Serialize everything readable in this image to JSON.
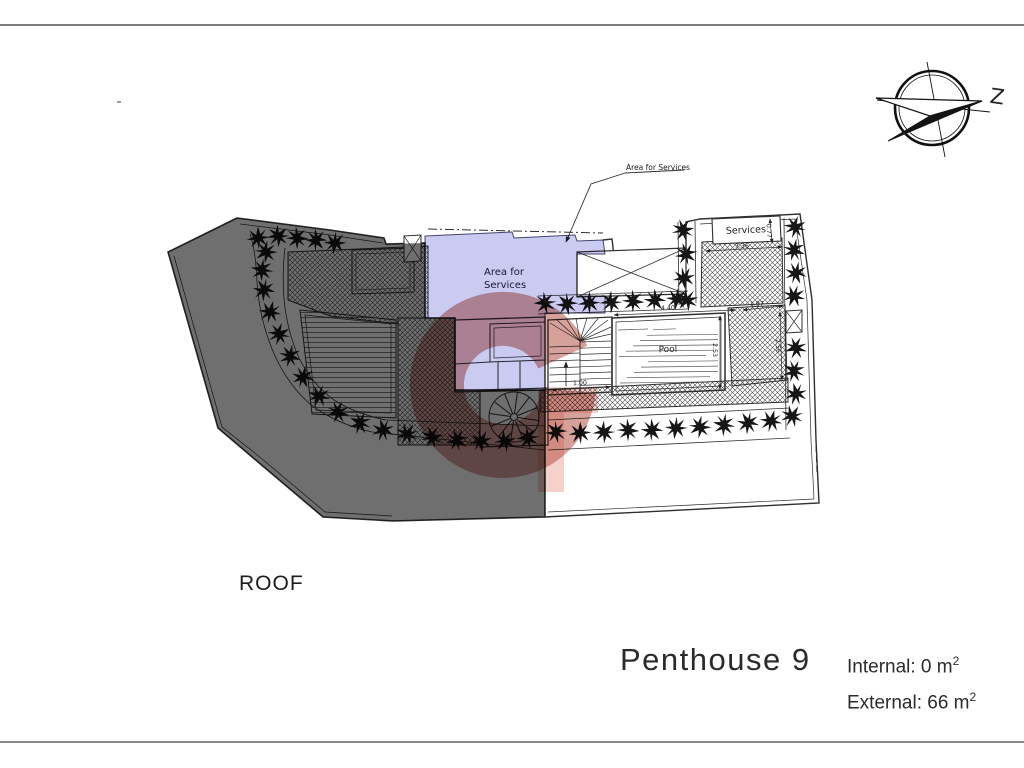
{
  "title_block": {
    "floor_label": "ROOF",
    "unit_name": "Penthouse 9",
    "internal_prefix": "Internal: 0 m",
    "internal_exp": "2",
    "external_prefix": "External: 66 m",
    "external_exp": "2"
  },
  "annotations": {
    "area_for_services_note": "Area for Services"
  },
  "plan_labels": {
    "area_line1": "Area for",
    "area_line2": "Services",
    "pool": "Pool",
    "services": "Services"
  },
  "dimensions": {
    "pool_width": "4.40",
    "pool_height": "2.53",
    "services_width": "3.36",
    "services_height": "0.77",
    "court_width": "1.97",
    "court_height": "2.56",
    "stair_width": "1.00"
  },
  "compass": {
    "north_label": "Z"
  },
  "colors": {
    "roof_overlay": "#6f6f6f",
    "services_overlay": "#cbcbf1",
    "watermark_ring": "#b04438",
    "watermark_bar": "#e79a8c",
    "line": "#2f2f2f"
  }
}
